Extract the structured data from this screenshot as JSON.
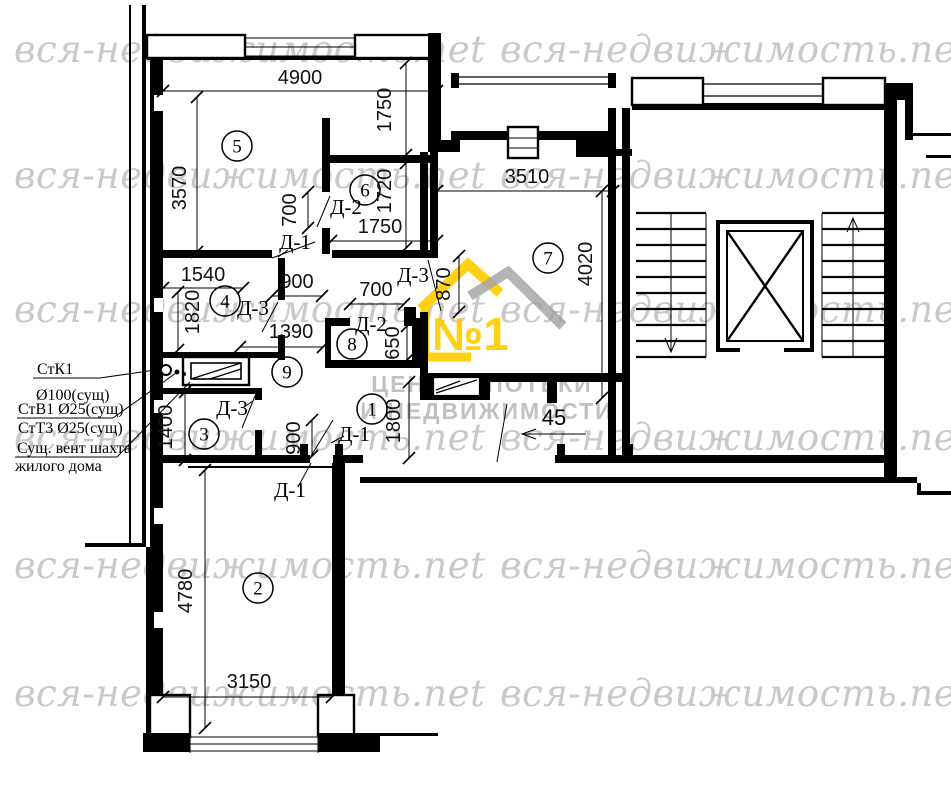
{
  "watermark": {
    "text": "вся-недвижимость.net",
    "color": "#c9c9c9",
    "rows": [
      28,
      154,
      288,
      416,
      544,
      672
    ],
    "cols": [
      14,
      500
    ]
  },
  "logo": {
    "number": "№1",
    "line1": "ЦЕНТР ИПОТЕКИ",
    "line2": "И НЕДВИЖИМОСТИ",
    "yellow": "#FFCE00",
    "gray": "#9f9f9f",
    "text_gray": "#ababab"
  },
  "plan": {
    "rooms": [
      {
        "n": "5",
        "x": 237,
        "y": 146
      },
      {
        "n": "6",
        "x": 365,
        "y": 190
      },
      {
        "n": "7",
        "x": 548,
        "y": 258
      },
      {
        "n": "4",
        "x": 225,
        "y": 301
      },
      {
        "n": "8",
        "x": 352,
        "y": 344
      },
      {
        "n": "9",
        "x": 287,
        "y": 372
      },
      {
        "n": "1",
        "x": 372,
        "y": 409
      },
      {
        "n": "3",
        "x": 204,
        "y": 434
      },
      {
        "n": "2",
        "x": 258,
        "y": 588
      }
    ],
    "dimensions": [
      {
        "text": "4900",
        "x": 300,
        "y": 84,
        "rot": 0,
        "line": [
          163,
          91,
          437,
          91
        ]
      },
      {
        "text": "3570",
        "x": 186,
        "y": 188,
        "rot": -90,
        "line": [
          197,
          97,
          197,
          252
        ]
      },
      {
        "text": "1750",
        "x": 391,
        "y": 110,
        "rot": -90,
        "line": [
          406,
          63,
          406,
          155
        ]
      },
      {
        "text": "1720",
        "x": 391,
        "y": 191,
        "rot": -90,
        "line": [
          406,
          163,
          406,
          248
        ]
      },
      {
        "text": "1750",
        "x": 380,
        "y": 233,
        "rot": 0,
        "line": [
          331,
          241,
          437,
          241
        ]
      },
      {
        "text": "3510",
        "x": 527,
        "y": 183,
        "rot": 0,
        "line": [
          437,
          191,
          613,
          191
        ]
      },
      {
        "text": "4020",
        "x": 592,
        "y": 264,
        "rot": -90,
        "line": [
          602,
          191,
          602,
          398
        ]
      },
      {
        "text": "870",
        "x": 450,
        "y": 284,
        "rot": -90,
        "line": [
          459,
          256,
          459,
          312
        ]
      },
      {
        "text": "700",
        "x": 296,
        "y": 210,
        "rot": -90,
        "line": [
          308,
          192,
          308,
          228
        ]
      },
      {
        "text": "700",
        "x": 376,
        "y": 296,
        "rot": 0,
        "line": [
          350,
          304,
          404,
          304
        ]
      },
      {
        "text": "650",
        "x": 399,
        "y": 343,
        "rot": -90,
        "line": [
          407,
          326,
          407,
          360
        ]
      },
      {
        "text": "1390",
        "x": 291,
        "y": 338,
        "rot": 0,
        "line": [
          240,
          347,
          323,
          347
        ]
      },
      {
        "text": "1540",
        "x": 203,
        "y": 281,
        "rot": 0,
        "line": [
          163,
          288,
          243,
          288
        ]
      },
      {
        "text": "1820",
        "x": 199,
        "y": 312,
        "rot": -90,
        "line": [
          178,
          292,
          178,
          350
        ]
      },
      {
        "text": "900",
        "x": 297,
        "y": 288,
        "rot": 0,
        "line": [
          272,
          296,
          322,
          296
        ]
      },
      {
        "text": "900",
        "x": 300,
        "y": 438,
        "rot": -90,
        "line": [
          312,
          420,
          312,
          456
        ]
      },
      {
        "text": "1400",
        "x": 172,
        "y": 427,
        "rot": -90,
        "line": [
          185,
          392,
          185,
          460
        ]
      },
      {
        "text": "1800",
        "x": 400,
        "y": 421,
        "rot": -90,
        "line": [
          409,
          382,
          409,
          458
        ]
      },
      {
        "text": "4780",
        "x": 192,
        "y": 591,
        "rot": -90,
        "line": [
          205,
          470,
          205,
          728
        ]
      },
      {
        "text": "3150",
        "x": 249,
        "y": 688,
        "rot": 0,
        "line": [
          163,
          697,
          332,
          697
        ]
      }
    ],
    "door_labels": [
      {
        "text": "Д-2",
        "x": 346,
        "y": 214
      },
      {
        "text": "Д-1",
        "x": 295,
        "y": 249
      },
      {
        "text": "Д-3",
        "x": 413,
        "y": 282
      },
      {
        "text": "Д-3",
        "x": 253,
        "y": 315
      },
      {
        "text": "Д-2",
        "x": 371,
        "y": 331
      },
      {
        "text": "Д-3",
        "x": 232,
        "y": 415
      },
      {
        "text": "Д-1",
        "x": 354,
        "y": 441
      },
      {
        "text": "Д-1",
        "x": 290,
        "y": 497
      }
    ],
    "annotations": {
      "stk1": "СтК1",
      "d100": "Ø100(сущ)",
      "stv1": "СтВ1 Ø25(сущ)",
      "stt3": "СтТ3 Ø25(сущ)",
      "vent1": "Сущ. вент шахта",
      "vent2": "жилого дома"
    },
    "flat_number": "45"
  }
}
